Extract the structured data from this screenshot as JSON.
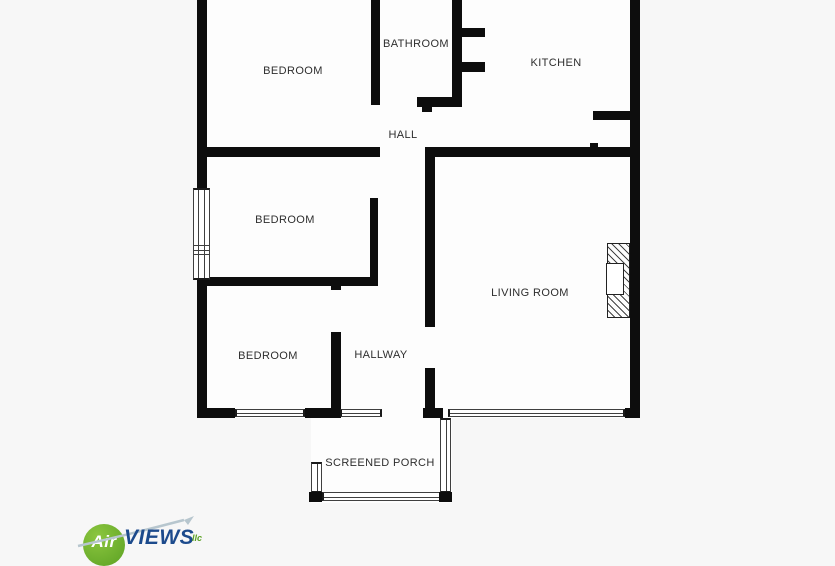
{
  "floorplan": {
    "rooms": [
      {
        "name": "bedroom-top",
        "label": "BEDROOM"
      },
      {
        "name": "bathroom",
        "label": "BATHROOM"
      },
      {
        "name": "kitchen",
        "label": "KITCHEN"
      },
      {
        "name": "hall",
        "label": "HALL"
      },
      {
        "name": "bedroom-middle",
        "label": "BEDROOM"
      },
      {
        "name": "living-room",
        "label": "LIVING ROOM"
      },
      {
        "name": "bedroom-bottom",
        "label": "BEDROOM"
      },
      {
        "name": "hallway",
        "label": "HALLWAY"
      },
      {
        "name": "screened-porch",
        "label": "SCREENED PORCH"
      }
    ]
  },
  "watermark": {
    "circle_text": "Air",
    "brand_text": "VIEWS",
    "suffix_text": "llc"
  },
  "colors": {
    "background": "#f7f7f7",
    "interior": "#fdfdfd",
    "wall": "#0d0d0d",
    "logo_green": "#5ba123",
    "logo_blue": "#1c4a8c"
  }
}
